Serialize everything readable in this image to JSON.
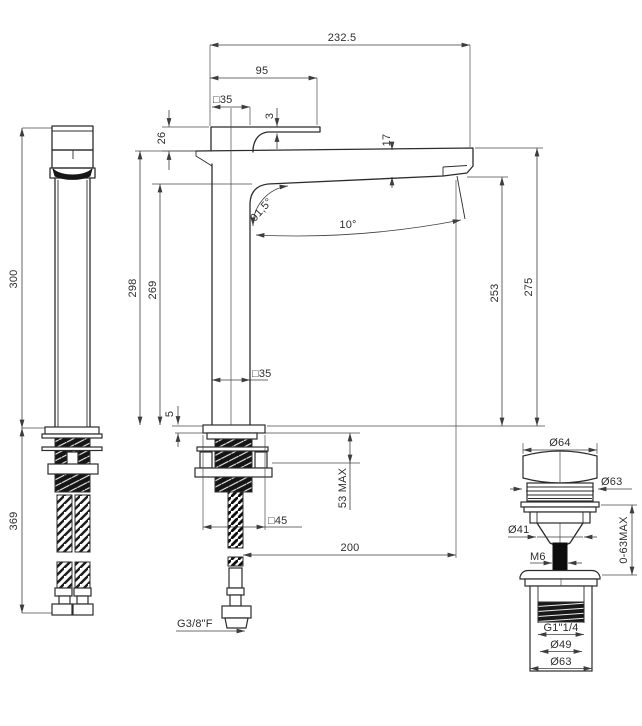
{
  "colors": {
    "background": "#ffffff",
    "line": "#2c2c2c",
    "dim_line": "#3d3d3d",
    "text": "#2e2e2e",
    "dark_fill": "#161616"
  },
  "side_view": {
    "height": "300",
    "below_deck": "369"
  },
  "front_view": {
    "overall_width": "232.5",
    "spout_top": "95",
    "handle_square": "□35",
    "lever_gap": "3",
    "handle_height": "26",
    "spout_section": "17",
    "spout_angle": "91,5°",
    "outlet_angle": "10°",
    "body_height": "298",
    "underside_height": "269",
    "outlet_height": "253",
    "tip_height": "275",
    "body_square": "□35",
    "base_thickness": "5",
    "deck_thickness": "53 MAX",
    "base_square": "□45",
    "outlet_reach": "200",
    "inlet_thread": "G3/8\"F"
  },
  "waste_view": {
    "cap_diameter": "Ø64",
    "lip_diameter": "Ø63",
    "body_diameter": "Ø41",
    "rod_thread": "M6",
    "deck_range": "0-63MAX",
    "connection_thread": "G1\"1/4",
    "bore_diameter": "Ø49",
    "flange_diameter": "Ø63"
  }
}
